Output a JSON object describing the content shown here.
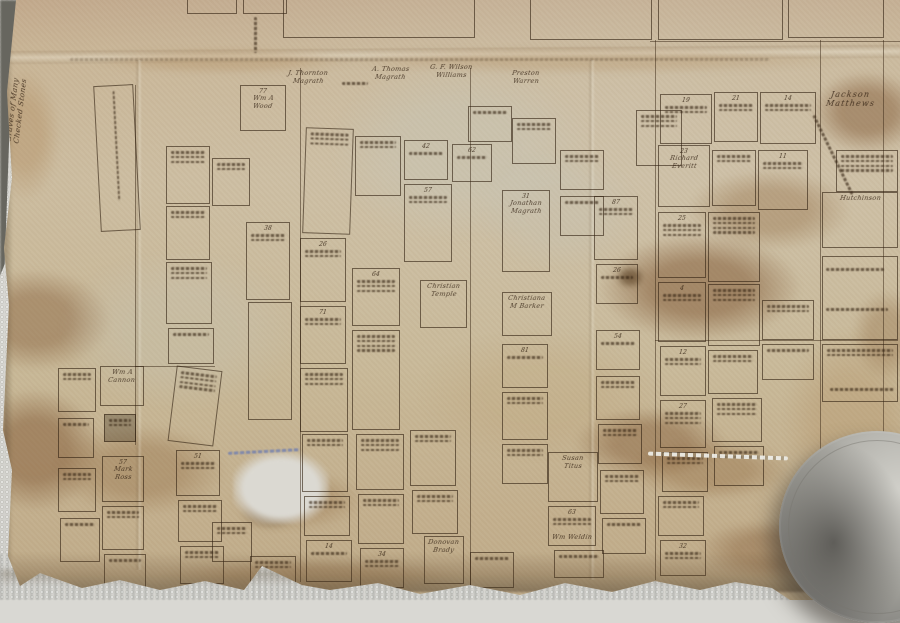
{
  "photo": {
    "subject": "old hand-drawn cemetery plot map on stained paper",
    "paper_color": "#c8b897",
    "towel_color": "#d8d7d2",
    "ink_color": "#32220f",
    "stain_color": "#7d5430",
    "paperweight_color": "#9d9c96"
  },
  "margin_note": {
    "line1": "Graves of Many",
    "line2": "Checked Stones"
  },
  "sections": [
    {
      "x": 283,
      "y": -34,
      "w": 192,
      "h": 72,
      "ltr": ""
    },
    {
      "x": 530,
      "y": -32,
      "w": 122,
      "h": 72,
      "ltr": ""
    },
    {
      "x": 658,
      "y": -30,
      "w": 125,
      "h": 70,
      "ltr": "G"
    },
    {
      "x": 788,
      "y": -30,
      "w": 96,
      "h": 68,
      "ltr": "H"
    },
    {
      "x": 187,
      "y": -16,
      "w": 50,
      "h": 30,
      "ltr": ""
    },
    {
      "x": 243,
      "y": -18,
      "w": 44,
      "h": 32,
      "ltr": ""
    }
  ],
  "inscriptions": [
    {
      "x": 288,
      "y": 70,
      "lines": [
        "J. Thornton",
        "Magrath"
      ]
    },
    {
      "x": 372,
      "y": 66,
      "lines": [
        "A. Thomas",
        "Magrath"
      ]
    },
    {
      "x": 430,
      "y": 64,
      "lines": [
        "G. F. Wilson",
        "Williams"
      ]
    },
    {
      "x": 512,
      "y": 70,
      "lines": [
        "Preston",
        "Warren"
      ]
    },
    {
      "x": 826,
      "y": 90,
      "lines": [
        "Jackson",
        "Matthews"
      ],
      "big": true
    },
    {
      "x": 552,
      "y": 534,
      "lines": [
        "Wm Weldin"
      ]
    }
  ],
  "plots": [
    {
      "x": 97,
      "y": 85,
      "w": 40,
      "h": 146,
      "rot": -3,
      "vscr": 110
    },
    {
      "x": 240,
      "y": 85,
      "w": 46,
      "h": 46,
      "num": "77",
      "lines": [
        "Wm A",
        "Wood"
      ]
    },
    {
      "x": 166,
      "y": 146,
      "w": 44,
      "h": 58,
      "scr": 3
    },
    {
      "x": 212,
      "y": 158,
      "w": 38,
      "h": 48,
      "scr": 2
    },
    {
      "x": 304,
      "y": 128,
      "w": 48,
      "h": 106,
      "rot": 2,
      "scr": 3
    },
    {
      "x": 355,
      "y": 136,
      "w": 46,
      "h": 60,
      "scr": 2
    },
    {
      "x": 404,
      "y": 140,
      "w": 44,
      "h": 40,
      "num": "42",
      "scr": 1
    },
    {
      "x": 452,
      "y": 144,
      "w": 40,
      "h": 38,
      "num": "62",
      "scr": 1
    },
    {
      "x": 404,
      "y": 184,
      "w": 48,
      "h": 78,
      "num": "57",
      "scr": 2
    },
    {
      "x": 468,
      "y": 106,
      "w": 44,
      "h": 36,
      "scr": 1
    },
    {
      "x": 512,
      "y": 118,
      "w": 44,
      "h": 46,
      "scr": 2
    },
    {
      "x": 560,
      "y": 150,
      "w": 44,
      "h": 40,
      "scr": 2
    },
    {
      "x": 636,
      "y": 110,
      "w": 46,
      "h": 56,
      "scr": 3
    },
    {
      "x": 660,
      "y": 94,
      "w": 52,
      "h": 50,
      "num": "19",
      "scr": 2
    },
    {
      "x": 714,
      "y": 92,
      "w": 44,
      "h": 50,
      "num": "21",
      "scr": 2
    },
    {
      "x": 760,
      "y": 92,
      "w": 56,
      "h": 52,
      "num": "14",
      "scr": 2
    },
    {
      "x": 658,
      "y": 145,
      "w": 52,
      "h": 62,
      "num": "23",
      "lines": [
        "Richard",
        "Everitt"
      ]
    },
    {
      "x": 712,
      "y": 150,
      "w": 44,
      "h": 56,
      "scr": 2
    },
    {
      "x": 758,
      "y": 150,
      "w": 50,
      "h": 60,
      "num": "11",
      "scr": 2
    },
    {
      "x": 836,
      "y": 150,
      "w": 62,
      "h": 42,
      "scr": 4
    },
    {
      "x": 822,
      "y": 192,
      "w": 76,
      "h": 56,
      "lines": [
        "Hutchinson"
      ]
    },
    {
      "x": 658,
      "y": 212,
      "w": 48,
      "h": 66,
      "num": "25",
      "scr": 3
    },
    {
      "x": 708,
      "y": 212,
      "w": 52,
      "h": 70,
      "scr": 4
    },
    {
      "x": 658,
      "y": 282,
      "w": 48,
      "h": 60,
      "num": "4",
      "scr": 2
    },
    {
      "x": 708,
      "y": 284,
      "w": 52,
      "h": 62,
      "scr": 3
    },
    {
      "x": 660,
      "y": 346,
      "w": 46,
      "h": 50,
      "num": "12",
      "scr": 2
    },
    {
      "x": 708,
      "y": 350,
      "w": 50,
      "h": 44,
      "scr": 2
    },
    {
      "x": 762,
      "y": 300,
      "w": 52,
      "h": 40,
      "scr": 2
    },
    {
      "x": 762,
      "y": 344,
      "w": 52,
      "h": 36,
      "scr": 1
    },
    {
      "x": 822,
      "y": 256,
      "w": 76,
      "h": 84
    },
    {
      "x": 822,
      "y": 344,
      "w": 76,
      "h": 58,
      "scr": 2
    },
    {
      "x": 502,
      "y": 190,
      "w": 48,
      "h": 82,
      "num": "31",
      "lines": [
        "Jonathan",
        "Magrath"
      ]
    },
    {
      "x": 560,
      "y": 196,
      "w": 44,
      "h": 40,
      "scr": 1
    },
    {
      "x": 594,
      "y": 196,
      "w": 44,
      "h": 64,
      "num": "87",
      "scr": 2
    },
    {
      "x": 596,
      "y": 264,
      "w": 42,
      "h": 40,
      "num": "26",
      "scr": 1
    },
    {
      "x": 420,
      "y": 280,
      "w": 47,
      "h": 48,
      "lines": [
        "Christian",
        "Temple"
      ]
    },
    {
      "x": 502,
      "y": 292,
      "w": 50,
      "h": 44,
      "lines": [
        "Christiana",
        "M Barker"
      ]
    },
    {
      "x": 352,
      "y": 268,
      "w": 48,
      "h": 58,
      "num": "64",
      "scr": 3
    },
    {
      "x": 352,
      "y": 330,
      "w": 48,
      "h": 100,
      "scr": 4
    },
    {
      "x": 300,
      "y": 238,
      "w": 46,
      "h": 64,
      "num": "26",
      "scr": 2
    },
    {
      "x": 300,
      "y": 306,
      "w": 46,
      "h": 58,
      "num": "71",
      "scr": 2
    },
    {
      "x": 300,
      "y": 368,
      "w": 48,
      "h": 64,
      "scr": 3
    },
    {
      "x": 246,
      "y": 222,
      "w": 44,
      "h": 78,
      "num": "38",
      "scr": 2
    },
    {
      "x": 248,
      "y": 302,
      "w": 44,
      "h": 118
    },
    {
      "x": 166,
      "y": 206,
      "w": 44,
      "h": 54,
      "scr": 2
    },
    {
      "x": 166,
      "y": 262,
      "w": 46,
      "h": 62,
      "scr": 3
    },
    {
      "x": 168,
      "y": 328,
      "w": 46,
      "h": 36,
      "scr": 1
    },
    {
      "x": 100,
      "y": 366,
      "w": 44,
      "h": 40,
      "lines": [
        "Wm A",
        "Cannon"
      ]
    },
    {
      "x": 104,
      "y": 414,
      "w": 32,
      "h": 28,
      "dark": true,
      "scr": 2
    },
    {
      "x": 102,
      "y": 456,
      "w": 42,
      "h": 46,
      "num": "57",
      "lines": [
        "Mark",
        "Ross"
      ]
    },
    {
      "x": 102,
      "y": 506,
      "w": 42,
      "h": 44,
      "scr": 2
    },
    {
      "x": 104,
      "y": 554,
      "w": 42,
      "h": 34,
      "scr": 1
    },
    {
      "x": 58,
      "y": 368,
      "w": 38,
      "h": 44,
      "scr": 2
    },
    {
      "x": 58,
      "y": 418,
      "w": 36,
      "h": 40,
      "scr": 1
    },
    {
      "x": 58,
      "y": 468,
      "w": 38,
      "h": 44,
      "scr": 2
    },
    {
      "x": 60,
      "y": 518,
      "w": 40,
      "h": 44,
      "scr": 1
    },
    {
      "x": 172,
      "y": 368,
      "w": 46,
      "h": 76,
      "rot": 7,
      "scr": 4
    },
    {
      "x": 176,
      "y": 450,
      "w": 44,
      "h": 46,
      "num": "51",
      "scr": 2
    },
    {
      "x": 178,
      "y": 500,
      "w": 44,
      "h": 42,
      "scr": 2
    },
    {
      "x": 180,
      "y": 546,
      "w": 44,
      "h": 38,
      "scr": 2
    },
    {
      "x": 212,
      "y": 522,
      "w": 40,
      "h": 40,
      "scr": 2
    },
    {
      "x": 250,
      "y": 556,
      "w": 46,
      "h": 36,
      "scr": 2
    },
    {
      "x": 302,
      "y": 434,
      "w": 46,
      "h": 58,
      "scr": 2
    },
    {
      "x": 304,
      "y": 496,
      "w": 46,
      "h": 40,
      "scr": 2
    },
    {
      "x": 306,
      "y": 540,
      "w": 46,
      "h": 42,
      "num": "14",
      "scr": 1
    },
    {
      "x": 356,
      "y": 434,
      "w": 48,
      "h": 56,
      "scr": 3
    },
    {
      "x": 358,
      "y": 494,
      "w": 46,
      "h": 50,
      "scr": 2
    },
    {
      "x": 360,
      "y": 548,
      "w": 44,
      "h": 40,
      "num": "34",
      "scr": 2
    },
    {
      "x": 410,
      "y": 430,
      "w": 46,
      "h": 56,
      "scr": 2
    },
    {
      "x": 412,
      "y": 490,
      "w": 46,
      "h": 44,
      "scr": 2
    },
    {
      "x": 424,
      "y": 536,
      "w": 40,
      "h": 48,
      "lines": [
        "Donovan",
        "Brady"
      ]
    },
    {
      "x": 470,
      "y": 552,
      "w": 44,
      "h": 36,
      "scr": 1
    },
    {
      "x": 502,
      "y": 344,
      "w": 46,
      "h": 44,
      "num": "81",
      "scr": 1
    },
    {
      "x": 502,
      "y": 392,
      "w": 46,
      "h": 48,
      "scr": 2
    },
    {
      "x": 502,
      "y": 444,
      "w": 46,
      "h": 40,
      "scr": 2
    },
    {
      "x": 548,
      "y": 452,
      "w": 50,
      "h": 50,
      "lines": [
        "Susan",
        "Titus"
      ]
    },
    {
      "x": 548,
      "y": 506,
      "w": 48,
      "h": 40,
      "num": "63",
      "scr": 2
    },
    {
      "x": 554,
      "y": 550,
      "w": 50,
      "h": 28,
      "scr": 1
    },
    {
      "x": 596,
      "y": 330,
      "w": 44,
      "h": 40,
      "num": "54",
      "scr": 1
    },
    {
      "x": 596,
      "y": 376,
      "w": 44,
      "h": 44,
      "scr": 2
    },
    {
      "x": 598,
      "y": 424,
      "w": 44,
      "h": 40,
      "scr": 2
    },
    {
      "x": 600,
      "y": 470,
      "w": 44,
      "h": 44,
      "scr": 2
    },
    {
      "x": 602,
      "y": 518,
      "w": 44,
      "h": 36,
      "scr": 1
    },
    {
      "x": 660,
      "y": 400,
      "w": 46,
      "h": 48,
      "num": "27",
      "scr": 3
    },
    {
      "x": 662,
      "y": 452,
      "w": 46,
      "h": 40,
      "scr": 2
    },
    {
      "x": 658,
      "y": 496,
      "w": 46,
      "h": 40,
      "scr": 2
    },
    {
      "x": 660,
      "y": 540,
      "w": 46,
      "h": 36,
      "num": "32",
      "scr": 2
    },
    {
      "x": 712,
      "y": 398,
      "w": 50,
      "h": 44,
      "scr": 3
    },
    {
      "x": 714,
      "y": 446,
      "w": 50,
      "h": 40,
      "scr": 2
    }
  ],
  "gridlines": [
    {
      "x": 135,
      "y": 85,
      "len": 360,
      "o": "v"
    },
    {
      "x": 300,
      "y": 68,
      "len": 514,
      "o": "v"
    },
    {
      "x": 470,
      "y": 68,
      "len": 517,
      "o": "v"
    },
    {
      "x": 655,
      "y": 40,
      "len": 540,
      "o": "v"
    },
    {
      "x": 820,
      "y": 40,
      "len": 515,
      "o": "v"
    },
    {
      "x": 883,
      "y": 40,
      "len": 505,
      "o": "v"
    },
    {
      "x": 655,
      "y": 340,
      "len": 243,
      "o": "h"
    },
    {
      "x": 650,
      "y": 41,
      "len": 250,
      "o": "h"
    },
    {
      "x": 135,
      "y": 366,
      "len": 80,
      "o": "h"
    }
  ],
  "scribbles": [
    {
      "x": 254,
      "y": 14,
      "len": 36,
      "vert": true
    },
    {
      "x": 790,
      "y": 152,
      "len": 88,
      "rot": 64
    },
    {
      "x": 228,
      "y": 448,
      "len": 72,
      "rot": -3,
      "blue": true
    },
    {
      "x": 70,
      "y": 56,
      "len": 700,
      "faint": true
    },
    {
      "x": 830,
      "y": 386,
      "len": 64
    },
    {
      "x": 826,
      "y": 266,
      "len": 58
    },
    {
      "x": 826,
      "y": 306,
      "len": 62
    },
    {
      "x": 342,
      "y": 80,
      "len": 26
    },
    {
      "x": 648,
      "y": 452,
      "len": 140,
      "rot": 2,
      "shiny": true
    }
  ],
  "stains": [
    {
      "x": -40,
      "y": 270,
      "w": 150,
      "h": 100,
      "c": "rgba(125,84,48,0.40)"
    },
    {
      "x": -30,
      "y": 390,
      "w": 130,
      "h": 120,
      "c": "rgba(125,84,48,0.48)"
    },
    {
      "x": 55,
      "y": 425,
      "w": 170,
      "h": 90,
      "c": "rgba(138,98,56,0.32)"
    },
    {
      "x": 600,
      "y": 235,
      "w": 200,
      "h": 105,
      "c": "rgba(125,84,48,0.50)"
    },
    {
      "x": 690,
      "y": 170,
      "w": 160,
      "h": 80,
      "c": "rgba(138,98,56,0.33)"
    },
    {
      "x": 812,
      "y": 72,
      "w": 110,
      "h": 80,
      "c": "rgba(125,84,48,0.45)"
    },
    {
      "x": 575,
      "y": 408,
      "w": 150,
      "h": 70,
      "c": "rgba(125,84,48,0.42)"
    },
    {
      "x": 630,
      "y": 440,
      "w": 160,
      "h": 60,
      "c": "rgba(138,98,56,0.35)"
    },
    {
      "x": 232,
      "y": 470,
      "w": 130,
      "h": 60,
      "c": "rgba(138,98,56,0.28)"
    },
    {
      "x": 95,
      "y": 48,
      "w": 260,
      "h": 26,
      "c": "rgba(169,127,78,0.25)"
    },
    {
      "x": 330,
      "y": 46,
      "w": 520,
      "h": 28,
      "c": "rgba(169,127,78,0.22)"
    },
    {
      "x": 784,
      "y": 330,
      "w": 130,
      "h": 180,
      "c": "rgba(169,127,78,0.22)"
    },
    {
      "x": -10,
      "y": 70,
      "w": 70,
      "h": 130,
      "c": "rgba(169,127,78,0.30)"
    },
    {
      "x": 852,
      "y": 290,
      "w": 70,
      "h": 90,
      "c": "rgba(138,98,56,0.30)"
    },
    {
      "x": 616,
      "y": 266,
      "w": 28,
      "h": 22,
      "c": "rgba(74,48,20,0.55)"
    },
    {
      "x": 240,
      "y": 494,
      "w": 60,
      "h": 36,
      "c": "rgba(74,48,20,0.30)"
    },
    {
      "x": 420,
      "y": 330,
      "w": 240,
      "h": 130,
      "c": "rgba(185,154,108,0.18)"
    },
    {
      "x": 330,
      "y": 60,
      "w": 260,
      "h": 180,
      "c": "rgba(197,201,190,0.30)"
    },
    {
      "x": 60,
      "y": 250,
      "w": 240,
      "h": 160,
      "c": "rgba(198,200,192,0.22)"
    },
    {
      "x": 480,
      "y": 150,
      "w": 160,
      "h": 120,
      "c": "rgba(195,198,189,0.22)"
    },
    {
      "x": 700,
      "y": 520,
      "w": 140,
      "h": 60,
      "c": "rgba(125,84,48,0.35)"
    },
    {
      "x": 160,
      "y": 558,
      "w": 300,
      "h": 40,
      "c": "rgba(138,98,56,0.25)"
    }
  ],
  "holes": [
    {
      "x": 233,
      "y": 452,
      "w": 96,
      "h": 72
    }
  ],
  "creases_v": [
    {
      "x": 588,
      "y": 60,
      "h": 520
    },
    {
      "x": 135,
      "y": 60,
      "h": 510
    }
  ]
}
